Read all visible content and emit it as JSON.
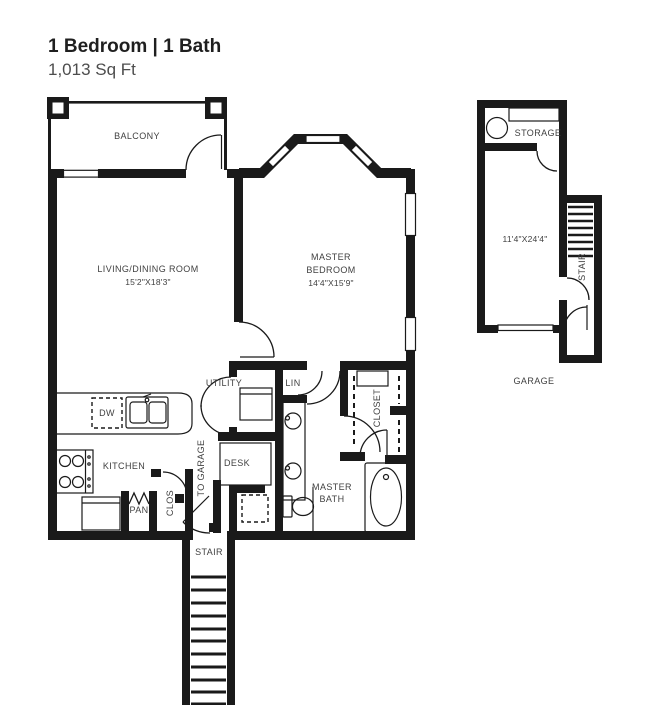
{
  "header": {
    "title": "1 Bedroom | 1 Bath",
    "subtitle": "1,013 Sq Ft"
  },
  "colors": {
    "wall": "#1a1a1a",
    "ink": "#414141",
    "bg": "#ffffff"
  },
  "unit": {
    "balcony": "BALCONY",
    "living_dining": {
      "name": "LIVING/DINING ROOM",
      "dims": "15'2\"X18'3\""
    },
    "master_bedroom": {
      "line1": "MASTER",
      "line2": "BEDROOM",
      "dims": "14'4\"X15'9\""
    },
    "utility": "UTILITY",
    "lin": "LIN",
    "closet": "CLOSET",
    "kitchen": "KITCHEN",
    "dishwasher": "DW",
    "desk": "DESK",
    "to_garage": "TO GARAGE",
    "clos": "CLOS",
    "pantry": "PAN",
    "master_bath": {
      "line1": "MASTER",
      "line2": "BATH"
    },
    "stair": "STAIR"
  },
  "garage": {
    "storage": "STORAGE",
    "dims": "11'4\"X24'4\"",
    "stair": "STAIR",
    "label": "GARAGE"
  }
}
